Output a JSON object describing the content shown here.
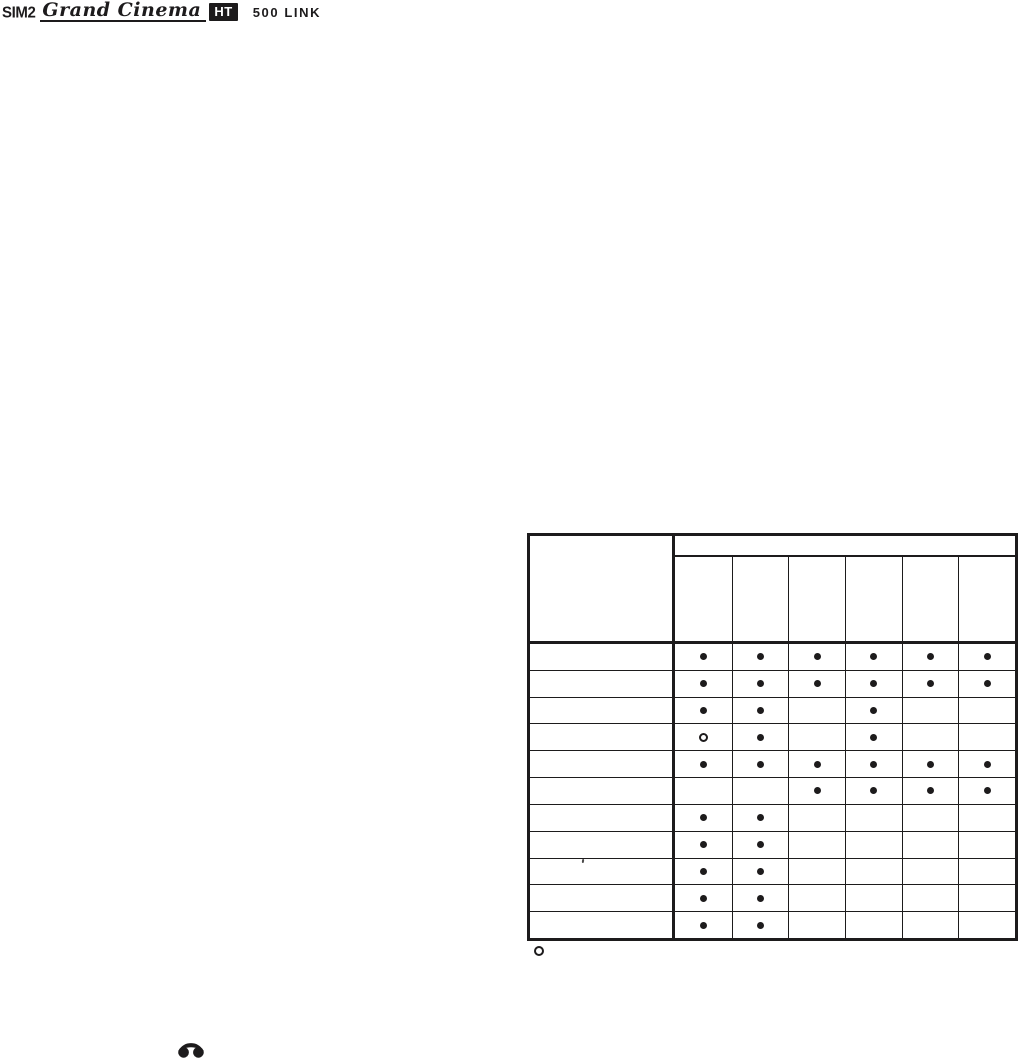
{
  "colors": {
    "ink": "#1d1b1c",
    "paper": "#ffffff"
  },
  "logo": {
    "brand": "SIM2",
    "series": "Grand Cinema",
    "badge": "HT",
    "model": "500 LINK"
  },
  "compatibility_table": {
    "corner_label": "",
    "group_header": "",
    "column_headers": [
      "",
      "",
      "",
      "",
      "",
      ""
    ],
    "marker_meanings": {
      "filled": "filled-dot",
      "open": "open-circle"
    },
    "rows": [
      {
        "label": "",
        "cells": [
          "filled",
          "filled",
          "filled",
          "filled",
          "filled",
          "filled"
        ]
      },
      {
        "label": "",
        "cells": [
          "filled",
          "filled",
          "filled",
          "filled",
          "filled",
          "filled"
        ]
      },
      {
        "label": "",
        "cells": [
          "filled",
          "filled",
          "",
          "filled",
          "",
          ""
        ]
      },
      {
        "label": "",
        "cells": [
          "open",
          "filled",
          "",
          "filled",
          "",
          ""
        ]
      },
      {
        "label": "",
        "cells": [
          "filled",
          "filled",
          "filled",
          "filled",
          "filled",
          "filled"
        ]
      },
      {
        "label": "",
        "cells": [
          "",
          "",
          "filled",
          "filled",
          "filled",
          "filled"
        ]
      },
      {
        "label": "",
        "cells": [
          "filled",
          "filled",
          "",
          "",
          "",
          ""
        ]
      },
      {
        "label": "",
        "cells": [
          "filled",
          "filled",
          "",
          "",
          "",
          ""
        ]
      },
      {
        "label": "",
        "cells": [
          "filled",
          "filled",
          "",
          "",
          "",
          ""
        ]
      },
      {
        "label": "",
        "cells": [
          "filled",
          "filled",
          "",
          "",
          "",
          ""
        ]
      },
      {
        "label": "",
        "cells": [
          "filled",
          "filled",
          "",
          "",
          "",
          ""
        ]
      }
    ],
    "legend_marker": "open"
  },
  "footer": {
    "phone_icon": "phone-handset-icon"
  }
}
